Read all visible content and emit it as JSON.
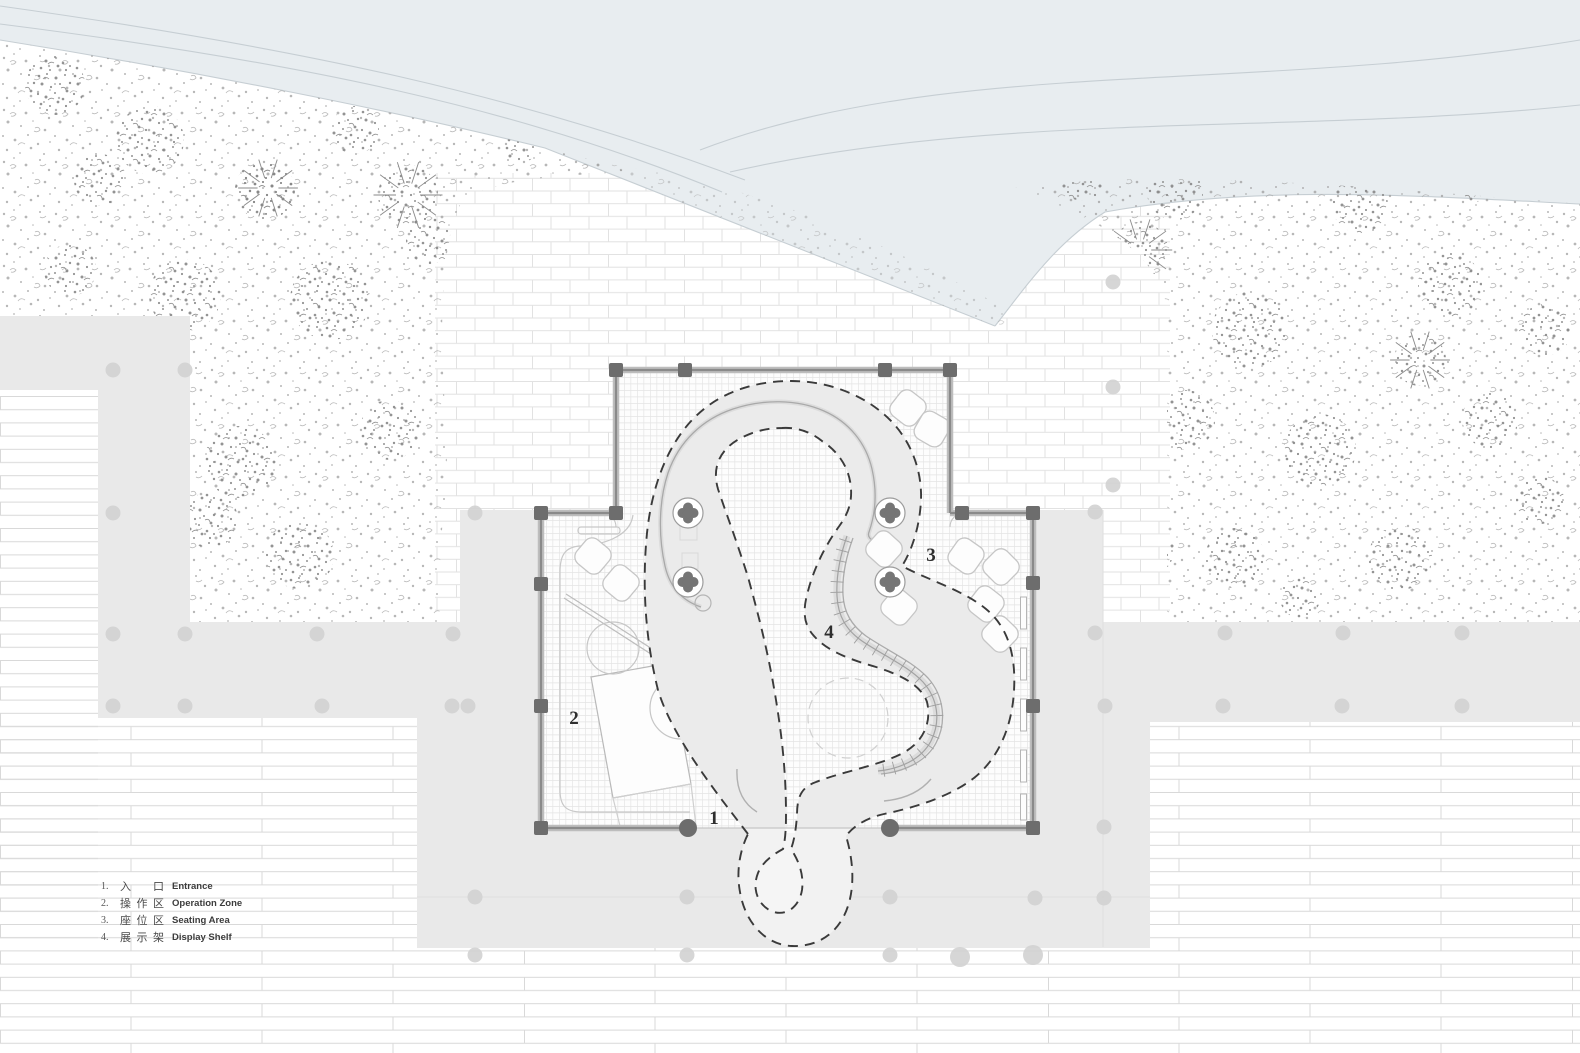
{
  "title": "Site floor plan",
  "legend": {
    "items": [
      {
        "num": "1.",
        "zh": "入口",
        "en": "Entrance"
      },
      {
        "num": "2.",
        "zh": "操作区",
        "en": "Operation Zone"
      },
      {
        "num": "3.",
        "zh": "座位区",
        "en": "Seating Area"
      },
      {
        "num": "4.",
        "zh": "展示架",
        "en": "Display Shelf"
      }
    ]
  },
  "markers": {
    "entrance": "1",
    "operation_zone": "2",
    "seating_area": "3",
    "display_shelf": "4"
  },
  "colors": {
    "water_road_band": "#e8edf0",
    "band_lines": "#c6ced3",
    "plaza_gray": "#e9e9e9",
    "tree_speckle": "#9f9f9f",
    "wall_gray": "#8a8a8a",
    "post_gray": "#6d6d6d",
    "dashed_path": "#3a3a3a",
    "paving_line": "#dcdcdc"
  }
}
